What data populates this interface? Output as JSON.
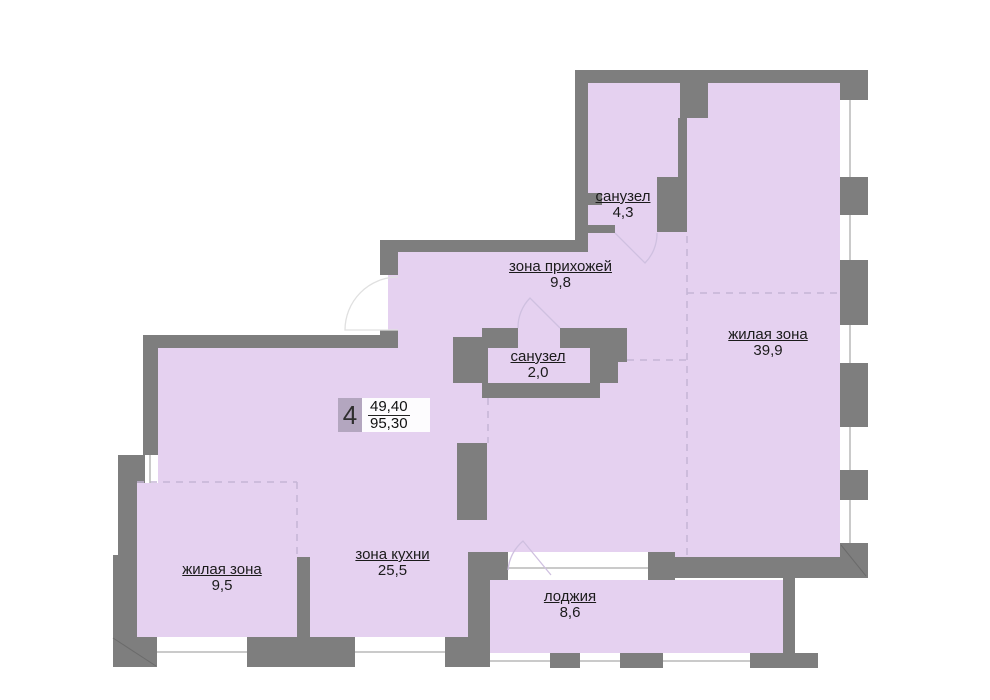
{
  "plan": {
    "type": "apartment-floor-plan",
    "apartment_badge": {
      "number": "4",
      "area_upper": "49,40",
      "area_lower": "95,30"
    },
    "rooms": [
      {
        "id": "bathroom-top",
        "name": "санузел",
        "area": "4,3"
      },
      {
        "id": "hallway-zone",
        "name": "зона прихожей",
        "area": "9,8"
      },
      {
        "id": "living-large",
        "name": "жилая зона",
        "area": "39,9"
      },
      {
        "id": "bathroom-small",
        "name": "санузел",
        "area": "2,0"
      },
      {
        "id": "living-small",
        "name": "жилая зона",
        "area": "9,5"
      },
      {
        "id": "kitchen-zone",
        "name": "зона кухни",
        "area": "25,5"
      },
      {
        "id": "loggia",
        "name": "лоджия",
        "area": "8,6"
      }
    ],
    "colors": {
      "wall": "#7e7e7e",
      "room_fill": "#e5d1f0",
      "badge_bg": "#b3a6bf",
      "zone_dash": "#c5b5d6",
      "window_frame": "#b8b8b8",
      "text": "#1b1b1b",
      "background": "#ffffff"
    }
  }
}
